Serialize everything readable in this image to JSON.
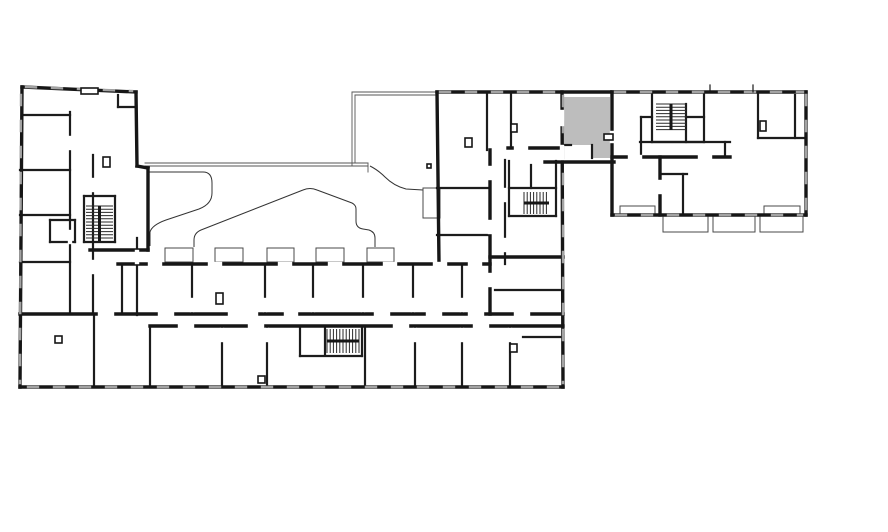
{
  "plan": {
    "description": "architectural floor plan, one unit highlighted",
    "canvas": {
      "w": 888,
      "h": 532
    },
    "colors": {
      "background": "#ffffff",
      "wall": "#161616",
      "wall_medium": "#1c1c1c",
      "thin": "#4a4a4a",
      "curve": "#333333",
      "canopy": "#555555",
      "window": "#a3a3a3",
      "door_gap": "#ffffff",
      "highlight": "#bdbdbd",
      "tread": "#2a2a2a"
    },
    "highlight_room": {
      "path": "M563,97 L610,97 L610,158 L592,158 L592,145 L563,145 Z",
      "label": "selected-unit"
    },
    "thick_walls": [
      [
        22,
        87,
        136,
        92
      ],
      [
        22,
        87,
        20,
        387
      ],
      [
        20,
        387,
        563,
        387
      ],
      [
        437,
        92,
        610,
        92
      ],
      [
        562,
        92,
        563,
        387
      ],
      [
        136,
        92,
        137,
        166
      ],
      [
        137,
        166,
        148,
        168
      ],
      [
        148,
        168,
        148,
        250
      ],
      [
        437,
        92,
        439,
        263
      ],
      [
        90,
        250,
        148,
        250
      ],
      [
        20,
        314,
        563,
        314
      ],
      [
        150,
        326,
        563,
        326
      ],
      [
        118,
        264,
        490,
        264
      ],
      [
        545,
        162,
        614,
        162
      ],
      [
        612,
        92,
        806,
        92
      ],
      [
        806,
        92,
        806,
        215
      ],
      [
        612,
        215,
        806,
        215
      ],
      [
        612,
        92,
        612,
        215
      ],
      [
        490,
        150,
        490,
        314
      ],
      [
        660,
        157,
        660,
        215
      ],
      [
        612,
        157,
        730,
        157
      ],
      [
        490,
        257,
        563,
        257
      ],
      [
        508,
        148,
        562,
        148
      ]
    ],
    "medium_walls": [
      [
        70,
        112,
        70,
        314
      ],
      [
        22,
        115,
        70,
        115
      ],
      [
        20,
        170,
        70,
        170
      ],
      [
        20,
        215,
        70,
        215
      ],
      [
        20,
        262,
        70,
        262
      ],
      [
        50,
        220,
        75,
        220
      ],
      [
        50,
        220,
        50,
        242
      ],
      [
        50,
        242,
        75,
        242
      ],
      [
        75,
        220,
        75,
        242
      ],
      [
        84,
        196,
        115,
        196
      ],
      [
        84,
        196,
        84,
        242
      ],
      [
        115,
        196,
        115,
        242
      ],
      [
        84,
        242,
        115,
        242
      ],
      [
        118,
        95,
        118,
        107
      ],
      [
        118,
        107,
        136,
        107
      ],
      [
        93,
        155,
        93,
        314
      ],
      [
        137,
        238,
        137,
        315
      ],
      [
        122,
        264,
        122,
        314
      ],
      [
        192,
        264,
        192,
        314
      ],
      [
        265,
        264,
        265,
        314
      ],
      [
        313,
        264,
        313,
        314
      ],
      [
        363,
        264,
        363,
        314
      ],
      [
        413,
        264,
        413,
        314
      ],
      [
        462,
        264,
        462,
        314
      ],
      [
        94,
        314,
        94,
        387
      ],
      [
        150,
        326,
        150,
        387
      ],
      [
        222,
        326,
        222,
        387
      ],
      [
        267,
        326,
        267,
        387
      ],
      [
        365,
        326,
        365,
        387
      ],
      [
        415,
        326,
        415,
        387
      ],
      [
        462,
        326,
        462,
        387
      ],
      [
        510,
        326,
        510,
        387
      ],
      [
        300,
        326,
        300,
        356
      ],
      [
        362,
        326,
        362,
        356
      ],
      [
        300,
        356,
        362,
        356
      ],
      [
        325,
        328,
        325,
        354
      ],
      [
        487,
        92,
        487,
        150
      ],
      [
        511,
        92,
        511,
        148
      ],
      [
        437,
        188,
        490,
        188
      ],
      [
        437,
        235,
        490,
        235
      ],
      [
        505,
        160,
        505,
        264
      ],
      [
        495,
        290,
        563,
        290
      ],
      [
        509,
        161,
        509,
        216
      ],
      [
        556,
        161,
        556,
        216
      ],
      [
        509,
        216,
        556,
        216
      ],
      [
        531,
        165,
        531,
        188
      ],
      [
        509,
        188,
        556,
        188
      ],
      [
        523,
        337,
        562,
        337
      ],
      [
        563,
        145,
        571,
        145
      ],
      [
        592,
        145,
        592,
        158
      ],
      [
        641,
        117,
        641,
        157
      ],
      [
        641,
        117,
        652,
        117
      ],
      [
        640,
        142,
        730,
        142
      ],
      [
        725,
        142,
        725,
        157
      ],
      [
        652,
        93,
        652,
        142
      ],
      [
        704,
        93,
        704,
        142
      ],
      [
        652,
        142,
        704,
        142
      ],
      [
        686,
        104,
        686,
        142
      ],
      [
        686,
        117,
        704,
        117
      ],
      [
        758,
        92,
        758,
        138
      ],
      [
        758,
        138,
        806,
        138
      ],
      [
        795,
        95,
        795,
        138
      ],
      [
        683,
        174,
        683,
        215
      ],
      [
        660,
        174,
        687,
        174
      ]
    ],
    "door_gaps": [
      [
        70,
        138,
        70,
        148
      ],
      [
        70,
        232,
        70,
        242
      ],
      [
        93,
        180,
        93,
        190
      ],
      [
        93,
        262,
        93,
        272
      ],
      [
        137,
        252,
        137,
        262
      ],
      [
        192,
        300,
        192,
        310
      ],
      [
        265,
        300,
        265,
        310
      ],
      [
        313,
        300,
        313,
        310
      ],
      [
        363,
        300,
        363,
        310
      ],
      [
        413,
        300,
        413,
        310
      ],
      [
        462,
        300,
        462,
        310
      ],
      [
        222,
        330,
        222,
        340
      ],
      [
        267,
        330,
        267,
        340
      ],
      [
        415,
        330,
        415,
        340
      ],
      [
        462,
        330,
        462,
        340
      ],
      [
        510,
        330,
        510,
        340
      ],
      [
        100,
        314,
        112,
        314
      ],
      [
        160,
        314,
        172,
        314
      ],
      [
        230,
        314,
        242,
        314
      ],
      [
        286,
        314,
        296,
        314
      ],
      [
        376,
        314,
        388,
        314
      ],
      [
        428,
        314,
        440,
        314
      ],
      [
        470,
        314,
        482,
        314
      ],
      [
        516,
        314,
        528,
        314
      ],
      [
        236,
        314,
        256,
        314
      ],
      [
        180,
        326,
        192,
        326
      ],
      [
        250,
        326,
        262,
        326
      ],
      [
        395,
        326,
        407,
        326
      ],
      [
        475,
        326,
        487,
        326
      ],
      [
        150,
        264,
        160,
        264
      ],
      [
        210,
        264,
        220,
        264
      ],
      [
        280,
        264,
        290,
        264
      ],
      [
        330,
        264,
        340,
        264
      ],
      [
        385,
        264,
        395,
        264
      ],
      [
        435,
        264,
        445,
        264
      ],
      [
        470,
        264,
        480,
        264
      ],
      [
        490,
        168,
        490,
        178
      ],
      [
        490,
        222,
        490,
        232
      ],
      [
        490,
        275,
        490,
        285
      ],
      [
        505,
        190,
        505,
        200
      ],
      [
        505,
        240,
        505,
        250
      ],
      [
        516,
        148,
        526,
        148
      ],
      [
        562,
        147,
        562,
        158
      ],
      [
        562,
        112,
        562,
        124
      ],
      [
        612,
        133,
        612,
        141
      ],
      [
        630,
        157,
        640,
        157
      ],
      [
        700,
        157,
        710,
        157
      ],
      [
        660,
        182,
        660,
        192
      ]
    ],
    "window_walls": [
      [
        21,
        95,
        20,
        383
      ],
      [
        28,
        387,
        558,
        387
      ],
      [
        563,
        96,
        563,
        383
      ],
      [
        440,
        92,
        558,
        92
      ],
      [
        26,
        87,
        132,
        91
      ],
      [
        615,
        92,
        803,
        92
      ],
      [
        806,
        95,
        806,
        212
      ],
      [
        616,
        215,
        802,
        215
      ]
    ],
    "canopy_lines": [
      [
        352,
        92,
        437,
        92
      ],
      [
        355,
        95,
        437,
        95
      ],
      [
        352,
        92,
        352,
        166
      ],
      [
        355,
        95,
        355,
        163
      ],
      [
        145,
        163,
        368,
        163
      ],
      [
        145,
        166,
        368,
        166
      ],
      [
        368,
        163,
        368,
        172
      ]
    ],
    "curves": [
      "M149,172 H203 Q212,172 212,183 V193 Q212,204 199,209 L166,220 Q152,225 150,232 L150,246",
      "M194,247 V240 Q194,233 201,230 L303,190 Q310,187 317,190 L352,203 Q356,205 356,209 V221 Q356,228 363,229 L369,230 Q375,232 375,238 V247",
      "M370,166 Q378,170 385,177 Q394,186 406,189 L423,190"
    ],
    "thin_rects": [
      [
        165,
        248,
        28,
        14
      ],
      [
        215,
        248,
        28,
        14
      ],
      [
        267,
        248,
        27,
        14
      ],
      [
        316,
        248,
        28,
        14
      ],
      [
        367,
        248,
        27,
        14
      ],
      [
        423,
        188,
        17,
        30
      ],
      [
        663,
        215,
        45,
        17
      ],
      [
        713,
        215,
        42,
        17
      ],
      [
        760,
        215,
        43,
        17
      ],
      [
        620,
        206,
        35,
        9
      ],
      [
        764,
        206,
        36,
        9
      ]
    ],
    "stairs": [
      {
        "x": 86,
        "y": 206,
        "w": 27,
        "h": 35,
        "dir": "v",
        "step": 3.2,
        "rail": "v"
      },
      {
        "x": 327,
        "y": 329,
        "w": 32,
        "h": 24,
        "dir": "h",
        "step": 3.2,
        "rail": "h"
      },
      {
        "x": 524,
        "y": 192,
        "w": 25,
        "h": 22,
        "dir": "h",
        "step": 3.2,
        "rail": "h"
      },
      {
        "x": 656,
        "y": 104,
        "w": 30,
        "h": 26,
        "dir": "v",
        "step": 3.2,
        "rail": "v"
      }
    ],
    "small_boxes": [
      [
        103,
        157,
        7,
        10
      ],
      [
        55,
        336,
        7,
        7
      ],
      [
        216,
        293,
        7,
        11
      ],
      [
        465,
        138,
        7,
        9
      ],
      [
        511,
        124,
        6,
        8
      ],
      [
        258,
        376,
        7,
        7
      ],
      [
        427,
        164,
        4,
        4
      ],
      [
        760,
        121,
        6,
        10
      ],
      [
        604,
        134,
        9,
        6
      ],
      [
        510,
        344,
        7,
        8
      ],
      [
        81,
        88,
        17,
        6
      ]
    ],
    "ticks": [
      [
        710,
        85,
        710,
        92
      ],
      [
        753,
        85,
        753,
        92
      ]
    ]
  }
}
